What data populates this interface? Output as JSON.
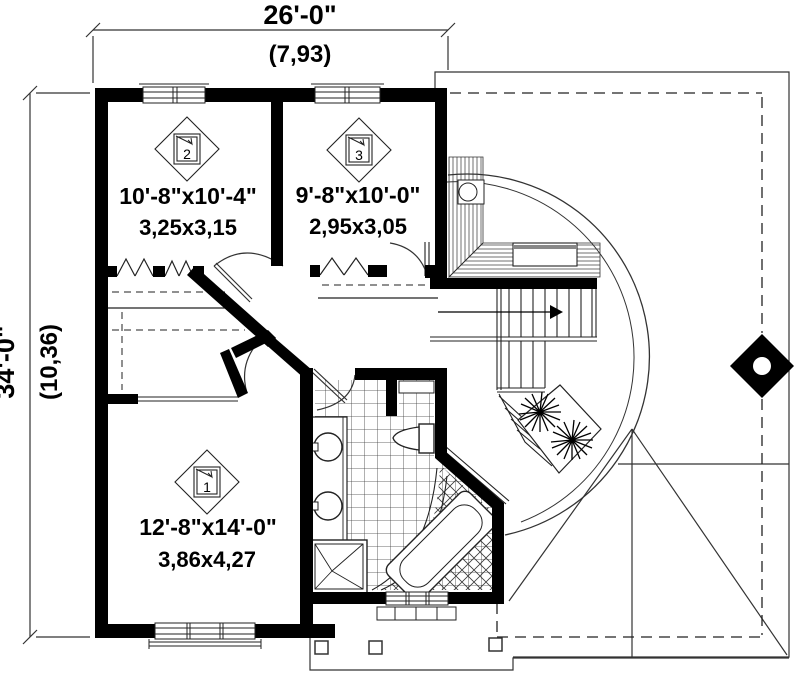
{
  "title": "second-floor-plan",
  "dimensions": {
    "top": {
      "imperial": "26'-0\"",
      "metric": "(7,93)"
    },
    "left": {
      "imperial": "34'-0\"",
      "metric": "(10,36)"
    }
  },
  "rooms": [
    {
      "marker": "1",
      "imperial": "12'-8\"x14'-0\"",
      "metric": "3,86x4,27"
    },
    {
      "marker": "2",
      "imperial": "10'-8\"x10'-4\"",
      "metric": "3,25x3,15"
    },
    {
      "marker": "3",
      "imperial": "9'-8\"x10'-0\"",
      "metric": "2,95x3,05"
    }
  ],
  "colors": {
    "wall": "#000000",
    "line": "#222222",
    "background": "#ffffff"
  }
}
